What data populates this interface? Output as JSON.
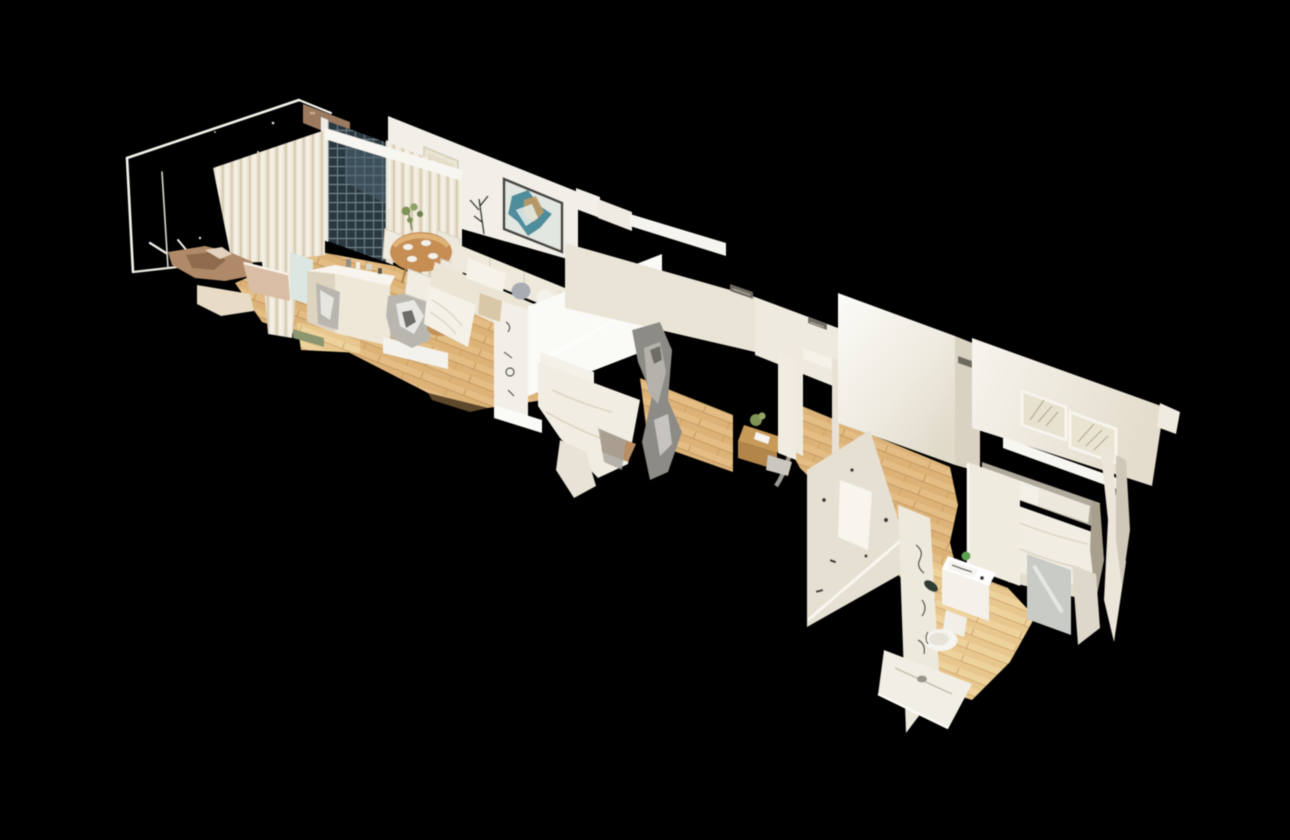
{
  "scene": {
    "app": "3D virtual tour viewer",
    "view_mode": "dollhouse-view",
    "subject": "Isometric 3D photogrammetry scan of an apartment floating on a black background",
    "background": "#000000"
  },
  "palette": {
    "background": "#000000",
    "wall_white": "#f2efe8",
    "wall_soft": "#eae4d7",
    "wall_bright": "#fafaf6",
    "wall_shadow": "#d9d2c2",
    "curtain": "#e9e0cd",
    "mesh_dark": "#2c3940",
    "mesh_grid": "#7e949c",
    "brick": "#9b7a5e",
    "floor_wood": "#dcb277",
    "floor_wood_light": "#e8c78e",
    "sofa_cream": "#ece5d6",
    "bed_white": "#f1ede2",
    "headboard_gray": "#b0aa9c",
    "table_wood": "#c68e52",
    "desk_wood": "#c89a58",
    "art_teal": "#4e8d9c",
    "art_gold": "#c09a62",
    "art_canvas": "#e7e1cf",
    "artifact_gray": "#8d8b86",
    "artifact_silver": "#b9b6b0",
    "plant_green": "#7f9355",
    "fixture_white": "#f6f4ef",
    "glass_gray": "#c9cbc6",
    "mark_dark": "#3a3834",
    "edge_white": "#f5f3ec"
  },
  "inventory": {
    "living_room": [
      "black-unscanned-wall",
      "mesh-shutter-door",
      "brick-strip",
      "curtains",
      "blank-canvas",
      "abstract-teal-artwork",
      "floor-lamp-artifact",
      "dining-table",
      "dining-chairs",
      "plant",
      "sofa",
      "throw-pillows",
      "kitchen-island",
      "tv-scan-artifact",
      "ottoman",
      "shag-pouf"
    ],
    "middle_bedroom": [
      "white-walls",
      "ac-vent",
      "bed",
      "mirror-scan-artifact",
      "desk",
      "desk-plant",
      "chair-scan-artifact",
      "doorway",
      "hallway-floor"
    ],
    "hallway": [
      "cut-wall",
      "ac-vent",
      "open-door-slab",
      "wood-floor-band"
    ],
    "master_bedroom": [
      "back-wall",
      "framed-line-art-1",
      "framed-line-art-2",
      "picture-ledge",
      "headboard",
      "bed-duvet",
      "pillows",
      "curtain-fragments"
    ],
    "bathroom": [
      "scribbled-wall",
      "vanity-sink",
      "towels",
      "toilet",
      "mirror-fragment",
      "shower-tray",
      "floor-drain",
      "wood-floor"
    ]
  }
}
